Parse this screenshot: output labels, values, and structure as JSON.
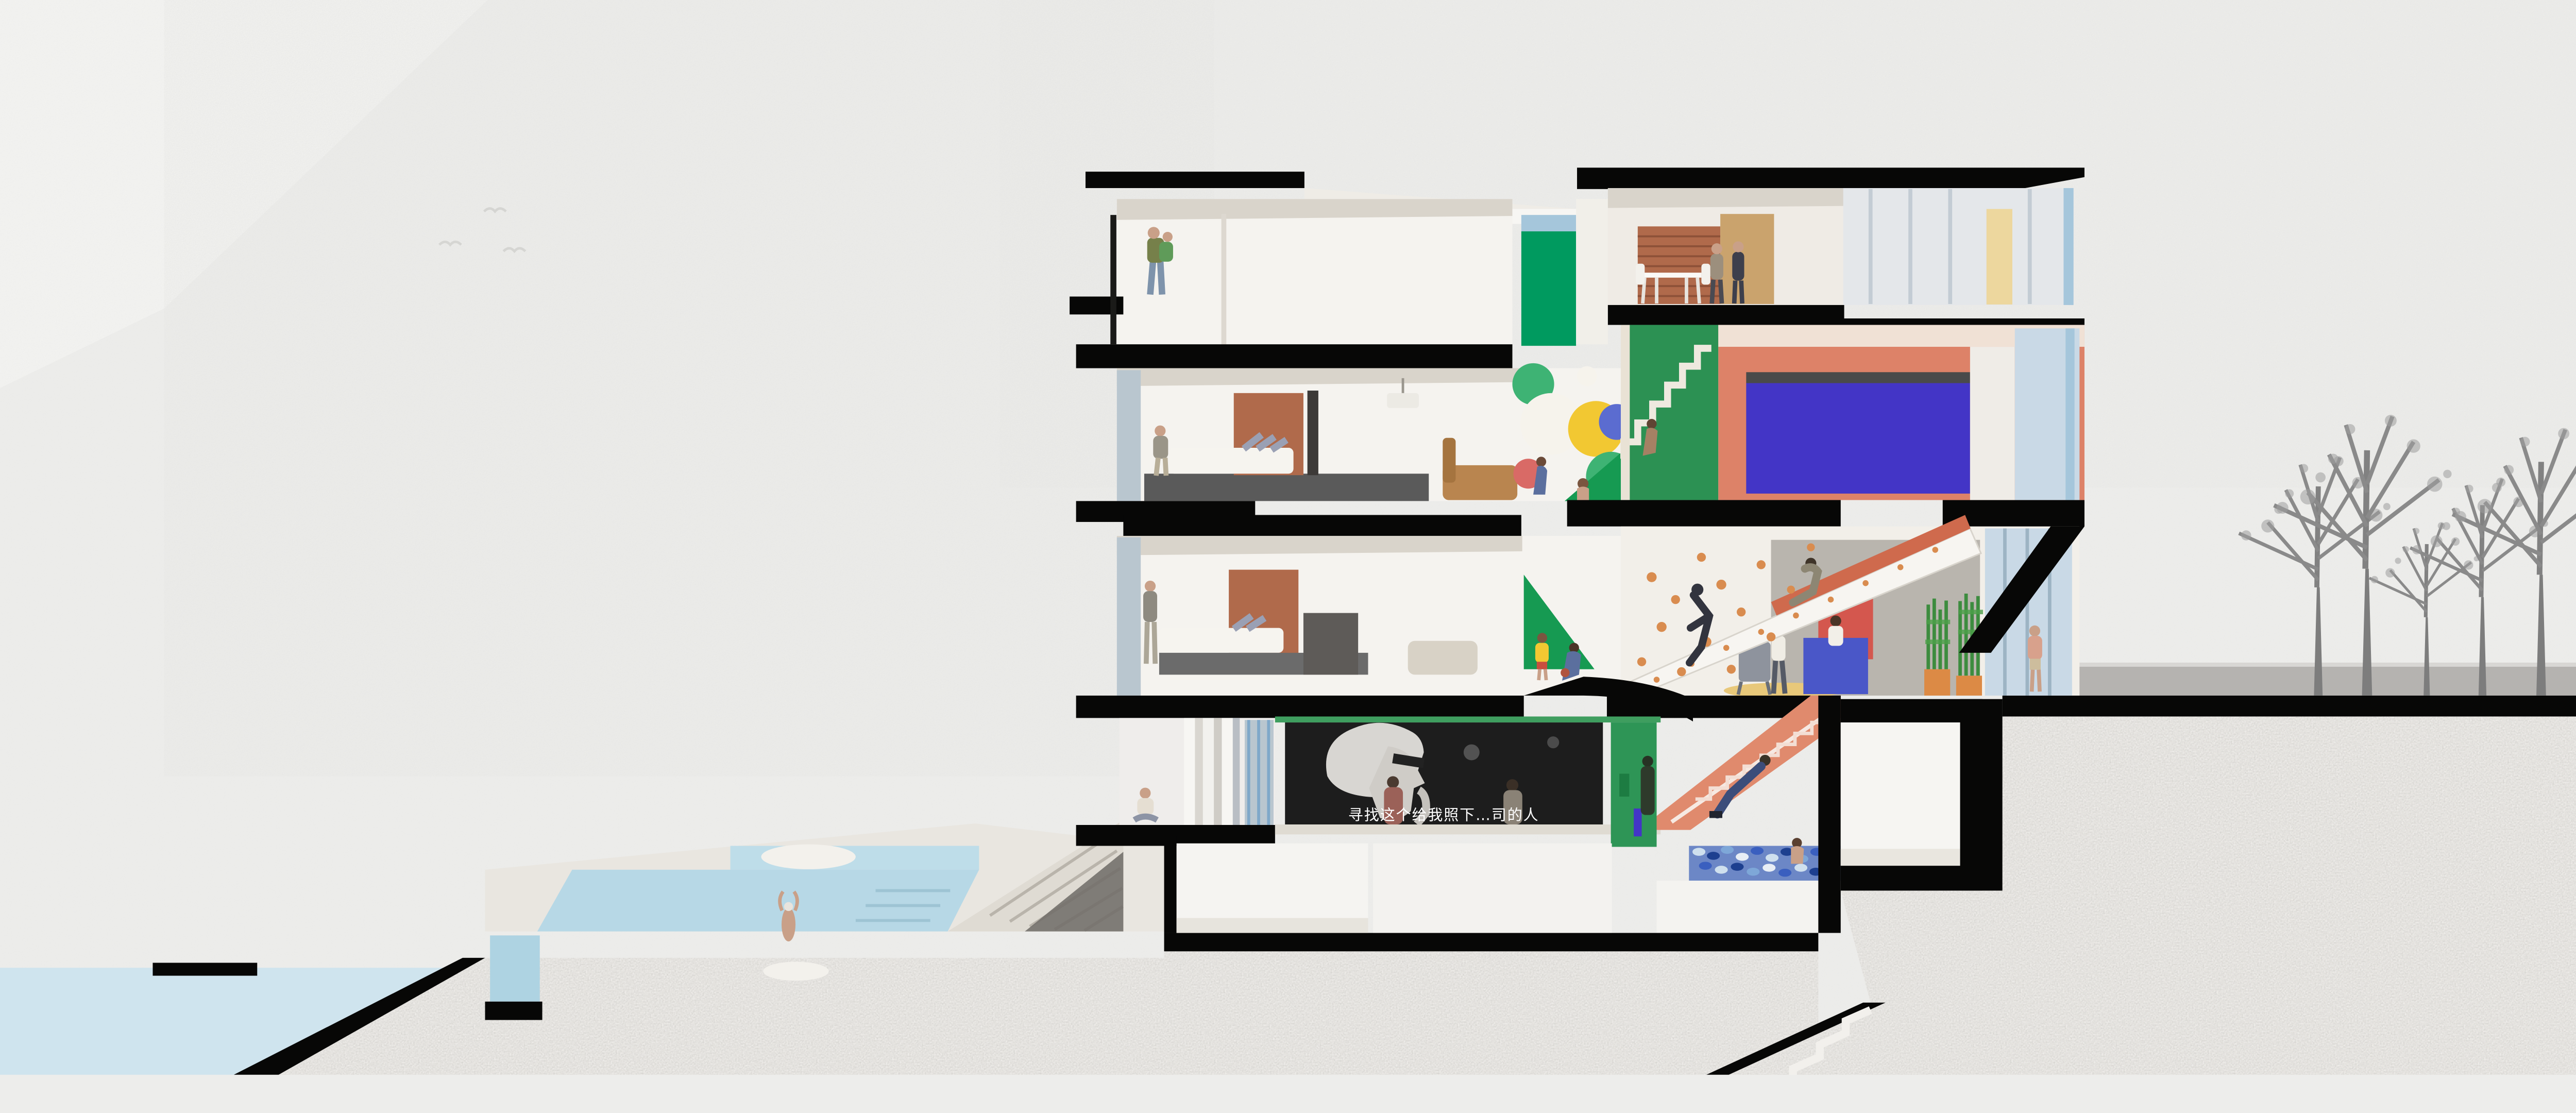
{
  "palette": {
    "paper": "#ededeb",
    "mountain_light": "#f3f3f1",
    "mountain_mid": "#e4e4e1",
    "mountain_far": "#e9e9e6",
    "ink": "#070706",
    "stipple_base": "#efedea",
    "water": "#cfe4ee",
    "pool_upper": "#bedde9",
    "pool_main": "#b7d8e6",
    "pool_tank": "#aed3e2",
    "deck": "#e9e6e0",
    "wall_white": "#f5f3ef",
    "ceiling_shadow": "#d9d4cb",
    "green_glass": "#009a5f",
    "green_stair_room": "#2c9153",
    "green_wall": "#2e9556",
    "green_triangle": "#169a52",
    "green_band": "#3f9e5f",
    "sky_blue_glass": "#a5c6db",
    "glass_pale": "#c9d9e6",
    "glass_left": "#b9c6cf",
    "brick": "#b06a4b",
    "wood": "#caa36d",
    "salmon_wall": "#dd8268",
    "salmon_stair": "#e08a6d",
    "orange_soffit": "#cf6a4d",
    "royal_blue": "#4335c6",
    "cream": "#edd79e",
    "yellow_balloon": "#f2c832",
    "red_balloon": "#d96a66",
    "blue_balloon": "#5b6cd0",
    "green_balloon": "#3eb374",
    "white_balloon": "#f6f3ec",
    "counter_blue": "#4a57c8",
    "red_panel": "#d4574e",
    "rug_yellow": "#e8c87a",
    "planter_orange": "#dc8a45",
    "plant_green": "#3d8c3f",
    "hold_orange": "#d98c4f",
    "screen_dark": "#1d1d1d",
    "sidewalk": "#b5b3b0",
    "tree_gray": "#8a8a8a",
    "skin": "#c9a088",
    "figure_dark": "#32343e"
  },
  "cinema": {
    "subtitle": "寻找这个给我照下…司的人"
  },
  "building": {
    "levels": 5,
    "balloon_colors": [
      "green",
      "white",
      "yellow",
      "red",
      "blue"
    ],
    "features": [
      "roof-terrace",
      "dining-room",
      "bedrooms",
      "balloon-wall",
      "green-stair",
      "climbing-wall",
      "reception",
      "cinema",
      "slide-stair",
      "ball-pit",
      "basement-room",
      "sunken-court"
    ]
  },
  "site": {
    "trees": 5,
    "birds": 3,
    "pool_floats": 2,
    "swimmers": 1
  }
}
